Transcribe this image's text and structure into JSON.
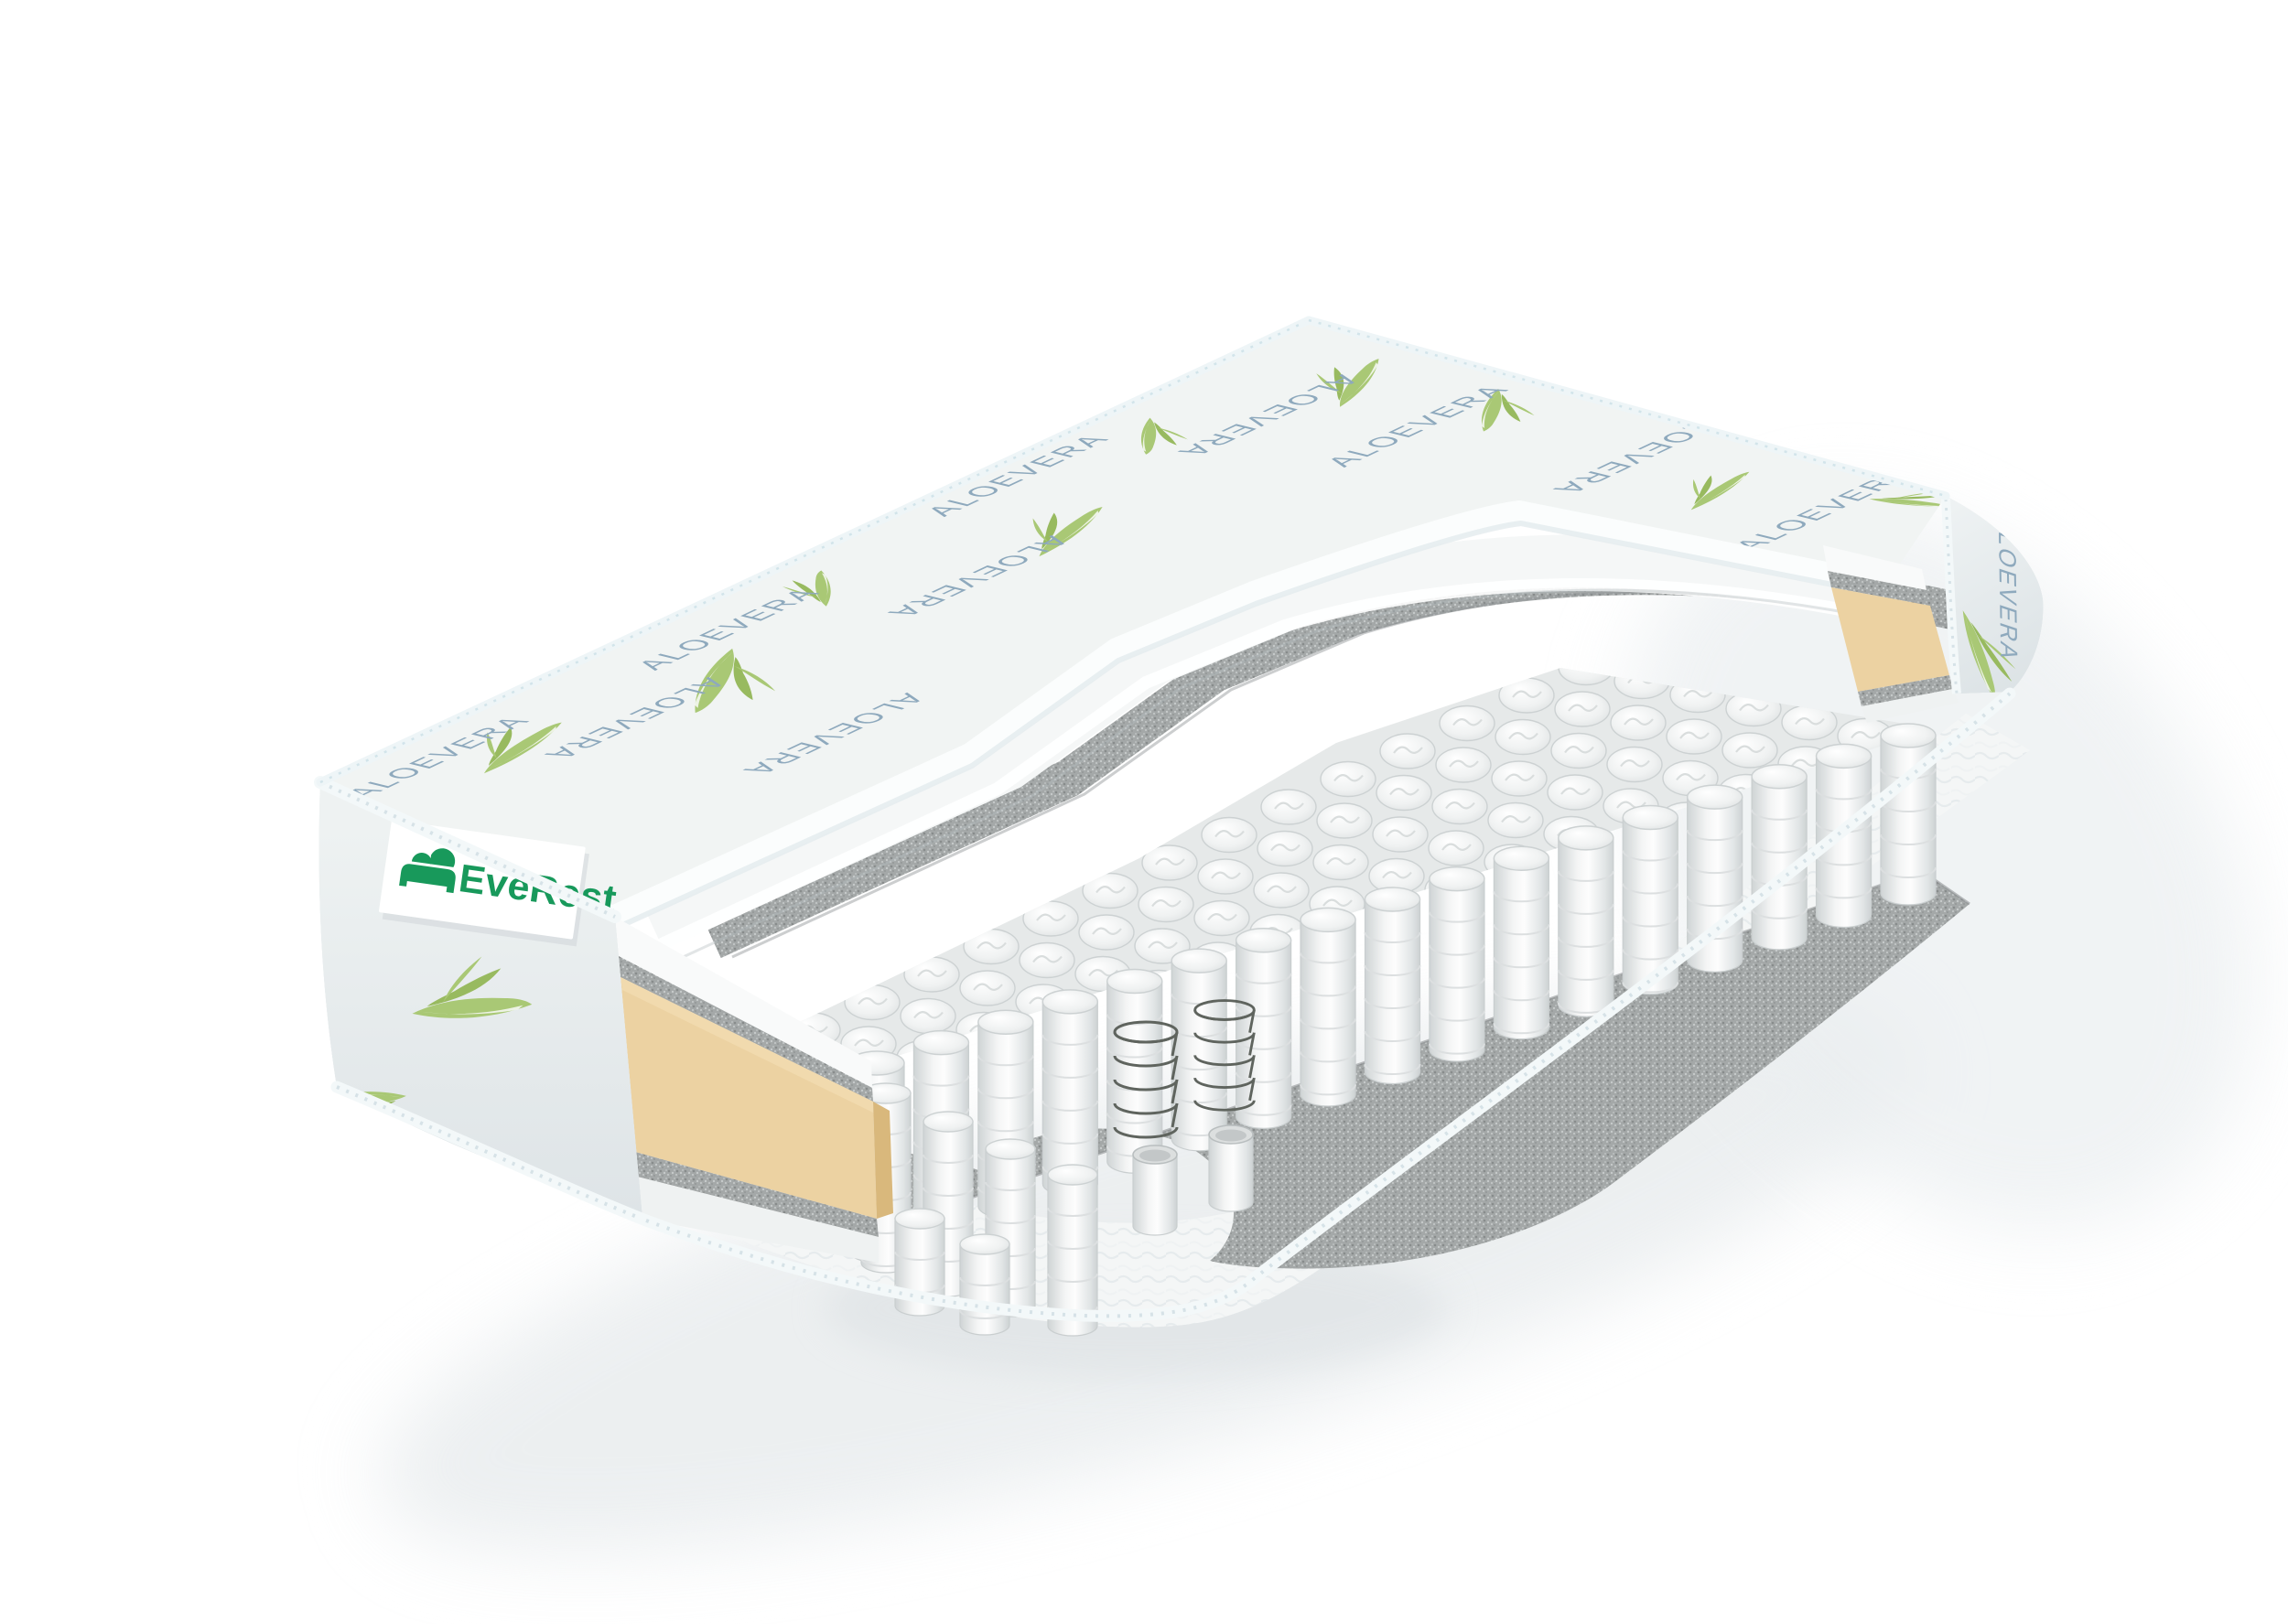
{
  "scene": {
    "background_color": "#ffffff",
    "shadow_color": "#e4e8ea",
    "subject": "mattress-cutaway-render"
  },
  "brand_label": {
    "text": "EveRest",
    "text_color": "#18995b",
    "background": "#ffffff",
    "icon": "bed-logo-icon"
  },
  "cover": {
    "pattern_text": "ALOEVERA",
    "pattern_text_color": "#8ea9bd",
    "leaf_color": "#a9c875",
    "leaf_accent_color": "#98ba5f",
    "fabric_color": "#f1f4f3",
    "fabric_side_color": "#e9eeef",
    "stitch_color": "#cbd6d9",
    "dot_color": "#b8c5ca",
    "piping_color": "#f3f8f9"
  },
  "layers": {
    "comfort_foam_color": "#f6f8f8",
    "felt_color": "#a4a8a8",
    "side_foam_color": "#ecd2a2",
    "side_foam_shade_color": "#d9b87c",
    "spring_fabric_color": "#f3f4f4",
    "spring_wire_color": "#5f645e",
    "base_foam_color": "#f4f6f6"
  }
}
